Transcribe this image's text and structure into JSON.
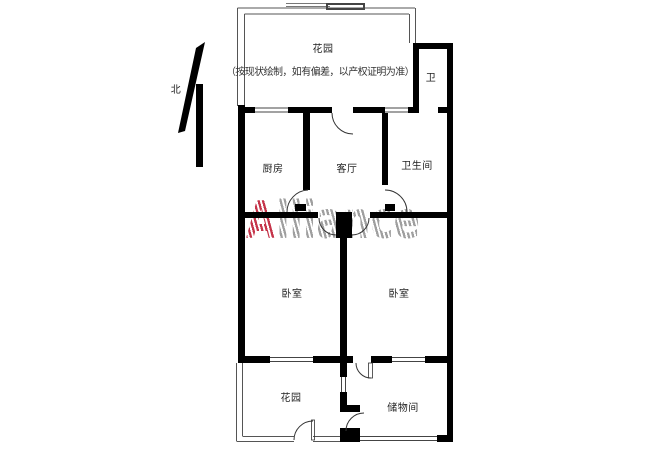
{
  "note": "（按现状绘制，如有偏差，以产权证明为准）",
  "north_label": "北",
  "watermark": {
    "lead": "A",
    "rest": "lliance"
  },
  "rooms": {
    "garden_top": "花园",
    "toilet_small": "卫",
    "kitchen": "厨房",
    "living_room": "客厅",
    "bathroom": "卫生间",
    "bedroom_left": "卧室",
    "bedroom_right": "卧室",
    "garden_bottom": "花园",
    "storage": "储物间"
  },
  "colors": {
    "wall_black": "#000000",
    "thin_line": "#555555",
    "watermark_red": "#c5344a",
    "watermark_gray": "#9f9f9f"
  }
}
